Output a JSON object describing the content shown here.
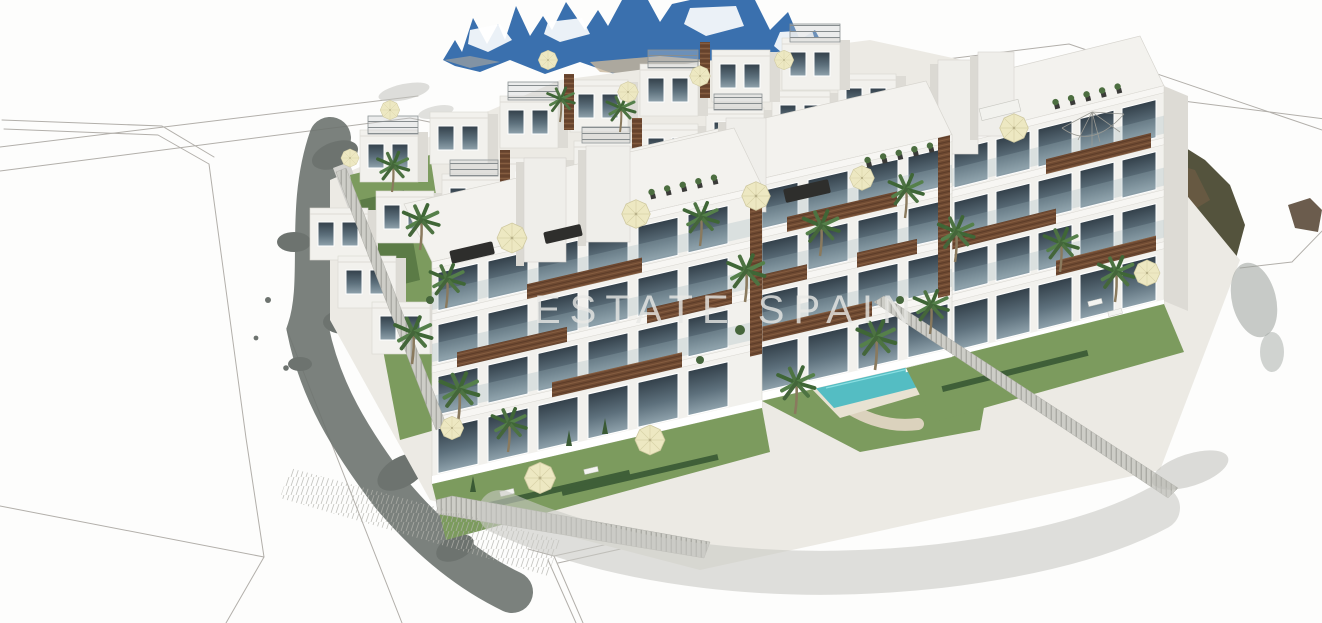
{
  "scene": {
    "type": "3d-architectural-rendering",
    "subject": "Aerial view of a modern white residential apartment complex with rooftop terraces, palm trees, private gardens and a turquoise swimming pool, blended into a white sketch background with watercolor blue mountains and gray shadow splashes",
    "watermark": "ESTATE SPAIN",
    "features": [
      "three 4-storey apartment blocks with wood-clad balcony parapets",
      "rows of rooftop townhouses with gray pergolas",
      "cream parasols on roof terraces and in ground-floor gardens",
      "turquoise swimming pool with sun loungers",
      "palm trees and green communal gardens",
      "light gray slatted perimeter fence",
      "dark asphalt parking area with white stall markings",
      "blue watercolor mountain ridge in the background",
      "rocky photo-collage patches at the top right",
      "thin sketched road and plot outlines on white ground"
    ]
  },
  "colors": {
    "background": "#fdfdfc",
    "sketch_line": "#b2afaa",
    "mountain_blue": "#3a70ae",
    "splash_dark": "#6d736f",
    "splash_light": "#c9c9c4",
    "facade_white": "#f2f1ed",
    "glass_dark": "#33404a",
    "wood_brown": "#6f4a32",
    "pool_turquoise": "#54bdc3",
    "umbrella_cream": "#ede8c2",
    "lawn_green": "#7c9b5e",
    "path_beige": "#dbd2bd",
    "asphalt_gray": "#898d87",
    "fence_gray": "#cdcdc7",
    "rock_brown": "#8d8274",
    "rock_dark": "#4b4a33"
  }
}
